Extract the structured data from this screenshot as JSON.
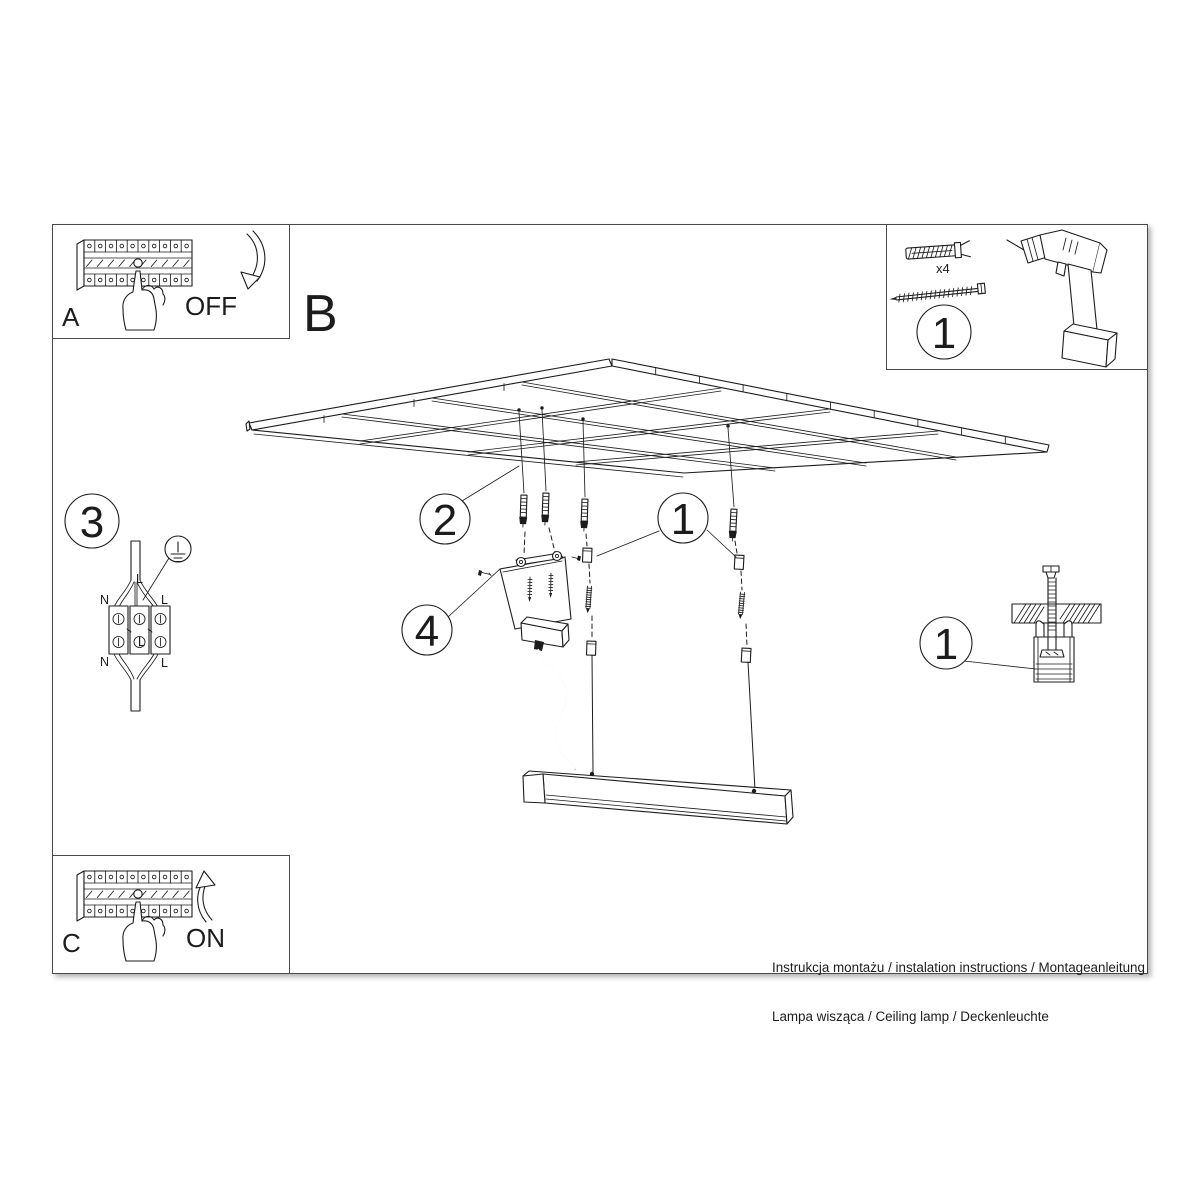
{
  "document": {
    "section_label": "B",
    "breaker_off": {
      "letter": "A",
      "state": "OFF"
    },
    "breaker_on": {
      "letter": "C",
      "state": "ON"
    },
    "tools": {
      "step": "1",
      "anchor_count": "x4"
    },
    "wiring": {
      "step": "3",
      "label_l_top": "L",
      "label_n_left": "N",
      "label_l_right": "L",
      "label_l_center": "L",
      "label_n_bottom": "N",
      "label_l_bottom": "L"
    },
    "callouts": {
      "ceiling_grid": "2",
      "suspension_set": "1",
      "mounting_bracket": "4",
      "anchor_detail": "1"
    },
    "footer": {
      "line1": "Instrukcja montażu / instalation instructions / Montageanleitung",
      "line2": "Lampa wisząca / Ceiling lamp / Deckenleuchte"
    }
  },
  "colors": {
    "ink": "#1c1c1c",
    "paper": "#ffffff",
    "frame": "#4a4a4a"
  }
}
